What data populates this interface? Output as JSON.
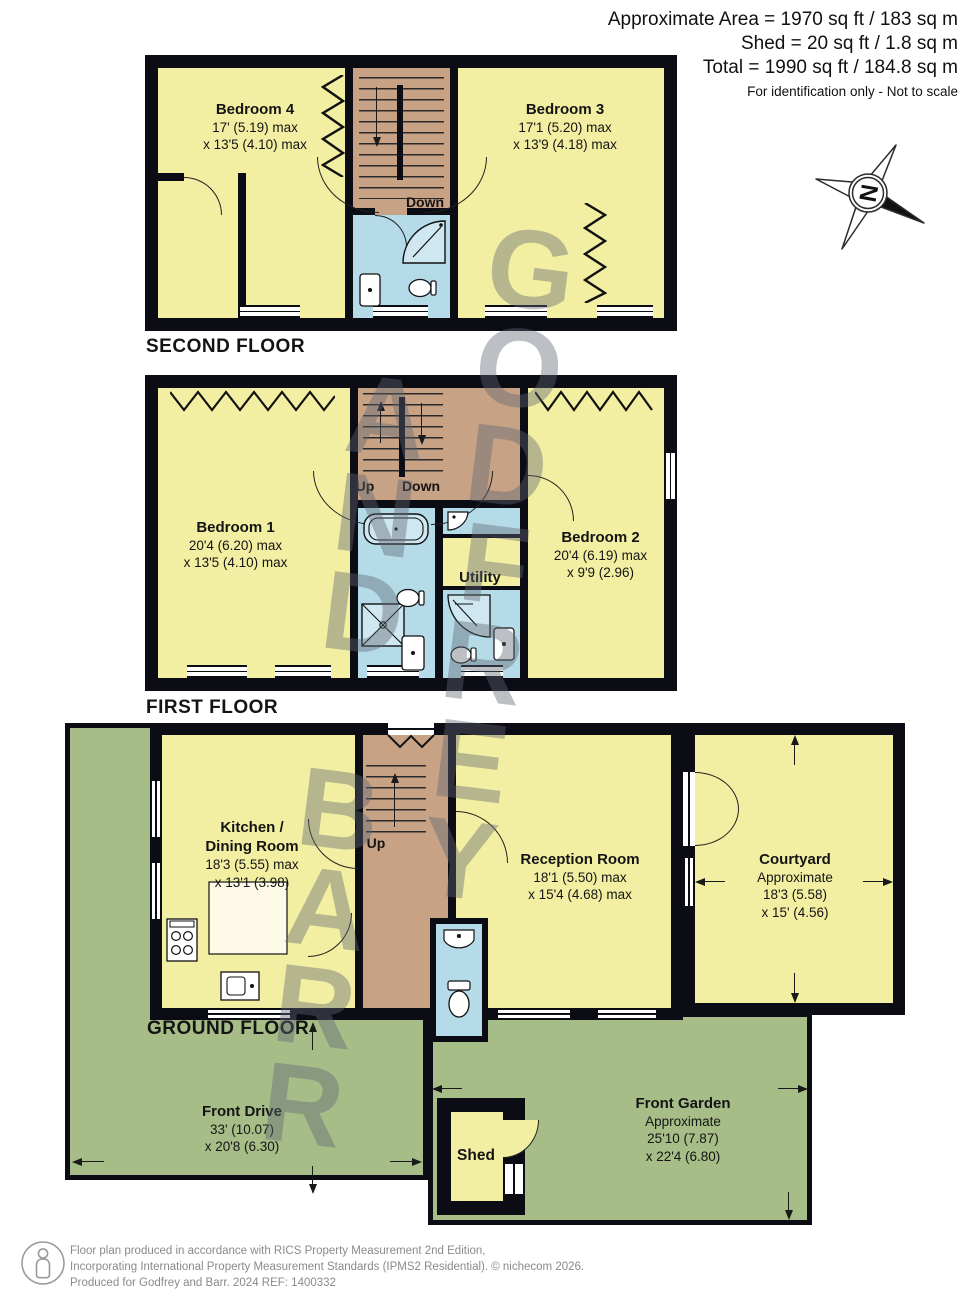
{
  "header": {
    "area": "Approximate Area = 1970 sq ft / 183 sq m",
    "shed": "Shed = 20 sq ft / 1.8 sq m",
    "total": "Total = 1990 sq ft / 184.8 sq m",
    "note": "For identification only - Not to scale"
  },
  "compass": {
    "n": "N"
  },
  "watermark": {
    "col1": "GODFREY",
    "col2": "AND BARR"
  },
  "second": {
    "label": "SECOND FLOOR",
    "bedroom4": {
      "name": "Bedroom 4",
      "d1": "17' (5.19) max",
      "d2": "x 13'5 (4.10) max"
    },
    "bedroom3": {
      "name": "Bedroom 3",
      "d1": "17'1 (5.20) max",
      "d2": "x 13'9 (4.18) max"
    },
    "down": "Down"
  },
  "first": {
    "label": "FIRST FLOOR",
    "bedroom1": {
      "name": "Bedroom 1",
      "d1": "20'4 (6.20) max",
      "d2": "x 13'5 (4.10) max"
    },
    "bedroom2": {
      "name": "Bedroom 2",
      "d1": "20'4 (6.19) max",
      "d2": "x 9'9 (2.96)"
    },
    "utility": "Utility",
    "up": "Up",
    "down": "Down"
  },
  "ground": {
    "label": "GROUND FLOOR",
    "kitchen": {
      "n1": "Kitchen /",
      "n2": "Dining Room",
      "d1": "18'3 (5.55) max",
      "d2": "x 13'1 (3.98)"
    },
    "reception": {
      "name": "Reception Room",
      "d1": "18'1 (5.50) max",
      "d2": "x 15'4 (4.68) max"
    },
    "courtyard": {
      "name": "Courtyard",
      "approx": "Approximate",
      "d1": "18'3 (5.58)",
      "d2": "x 15' (4.56)"
    },
    "front_drive": {
      "name": "Front Drive",
      "d1": "33' (10.07)",
      "d2": "x 20'8 (6.30)"
    },
    "front_garden": {
      "name": "Front Garden",
      "approx": "Approximate",
      "d1": "25'10 (7.87)",
      "d2": "x 22'4 (6.80)"
    },
    "shed": "Shed",
    "up": "Up"
  },
  "footer": {
    "l1": "Floor plan produced in accordance with RICS Property Measurement 2nd Edition,",
    "l2": "Incorporating International Property Measurement Standards (IPMS2 Residential).   © nichecom 2026.",
    "l3": "Produced for Godfrey and Barr.   2024   REF: 1400332"
  },
  "colors": {
    "wall": "#0c0c14",
    "room_yellow": "#f3efa2",
    "wet_blue": "#b5dbe8",
    "hall_tan": "#c8a285",
    "outdoor_green": "#a7bd88",
    "watermark_gray": "#60676f"
  }
}
